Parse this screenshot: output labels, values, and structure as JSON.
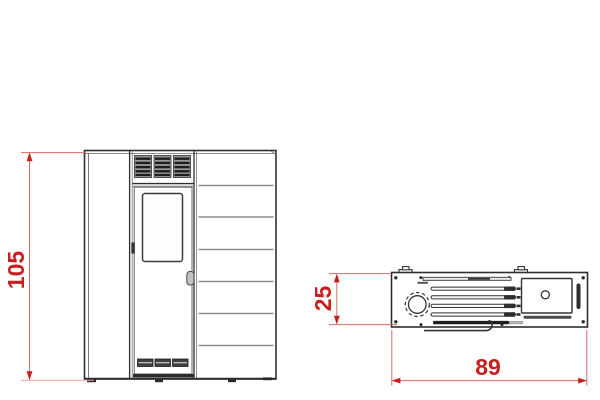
{
  "dimension_labels": {
    "height": "105",
    "depth": "25",
    "width": "89"
  },
  "colors": {
    "dimension_red": "#c81e1e",
    "dimension_line_red": "#d96a6a",
    "dimension_ext_pink": "#eba3a3",
    "outline_dark": "#2e2e2e",
    "panel_line_gray": "#8e8e8e"
  }
}
